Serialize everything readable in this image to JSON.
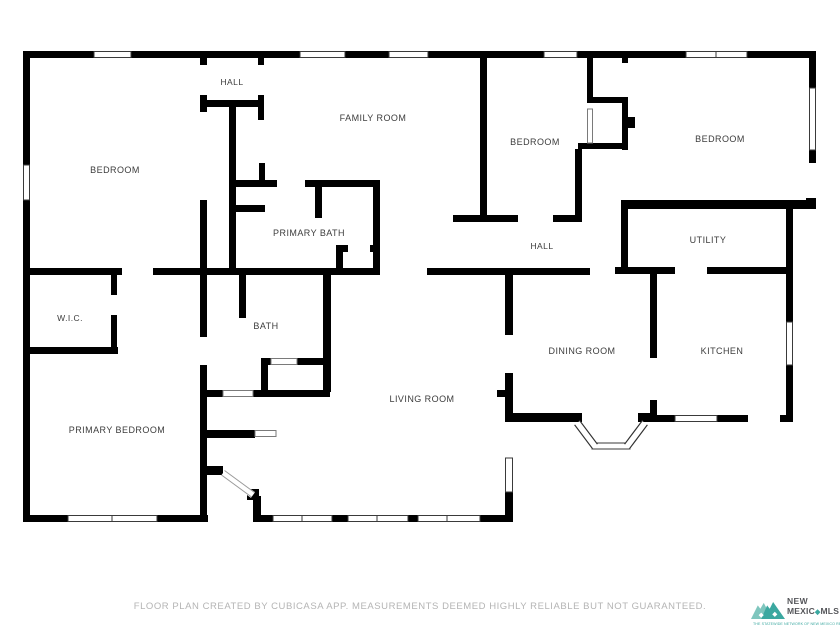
{
  "rooms": {
    "hall_top": {
      "label": "HALL"
    },
    "bedroom_left": {
      "label": "BEDROOM"
    },
    "family_room": {
      "label": "FAMILY ROOM"
    },
    "primary_bath": {
      "label": "PRIMARY BATH"
    },
    "bedroom_mid": {
      "label": "BEDROOM"
    },
    "bedroom_right": {
      "label": "BEDROOM"
    },
    "hall_mid": {
      "label": "HALL"
    },
    "utility": {
      "label": "UTILITY"
    },
    "wic": {
      "label": "W.I.C."
    },
    "bath": {
      "label": "BATH"
    },
    "kitchen": {
      "label": "KITCHEN"
    },
    "dining_room": {
      "label": "DINING ROOM"
    },
    "living_room": {
      "label": "LIVING ROOM"
    },
    "primary_bedroom": {
      "label": "PRIMARY BEDROOM"
    }
  },
  "footer": {
    "disclaimer": "FLOOR PLAN CREATED BY CUBICASA APP. MEASUREMENTS DEEMED HIGHLY RELIABLE BUT NOT GUARANTEED."
  },
  "logo": {
    "line1": "NEW",
    "line2_left": "MEXIC",
    "diamond": "◆",
    "line2_right": "MLS",
    "tagline": "THE STATEWIDE NETWORK OF NEW MEXICO REALTORS"
  },
  "colors": {
    "wall": "#000000",
    "background": "#ffffff",
    "label": "#3c3c3c",
    "footer": "#b4b4b4",
    "teal": "#3BA8A0",
    "teal_light": "#7FC6BE",
    "logo_text": "#55565A"
  }
}
